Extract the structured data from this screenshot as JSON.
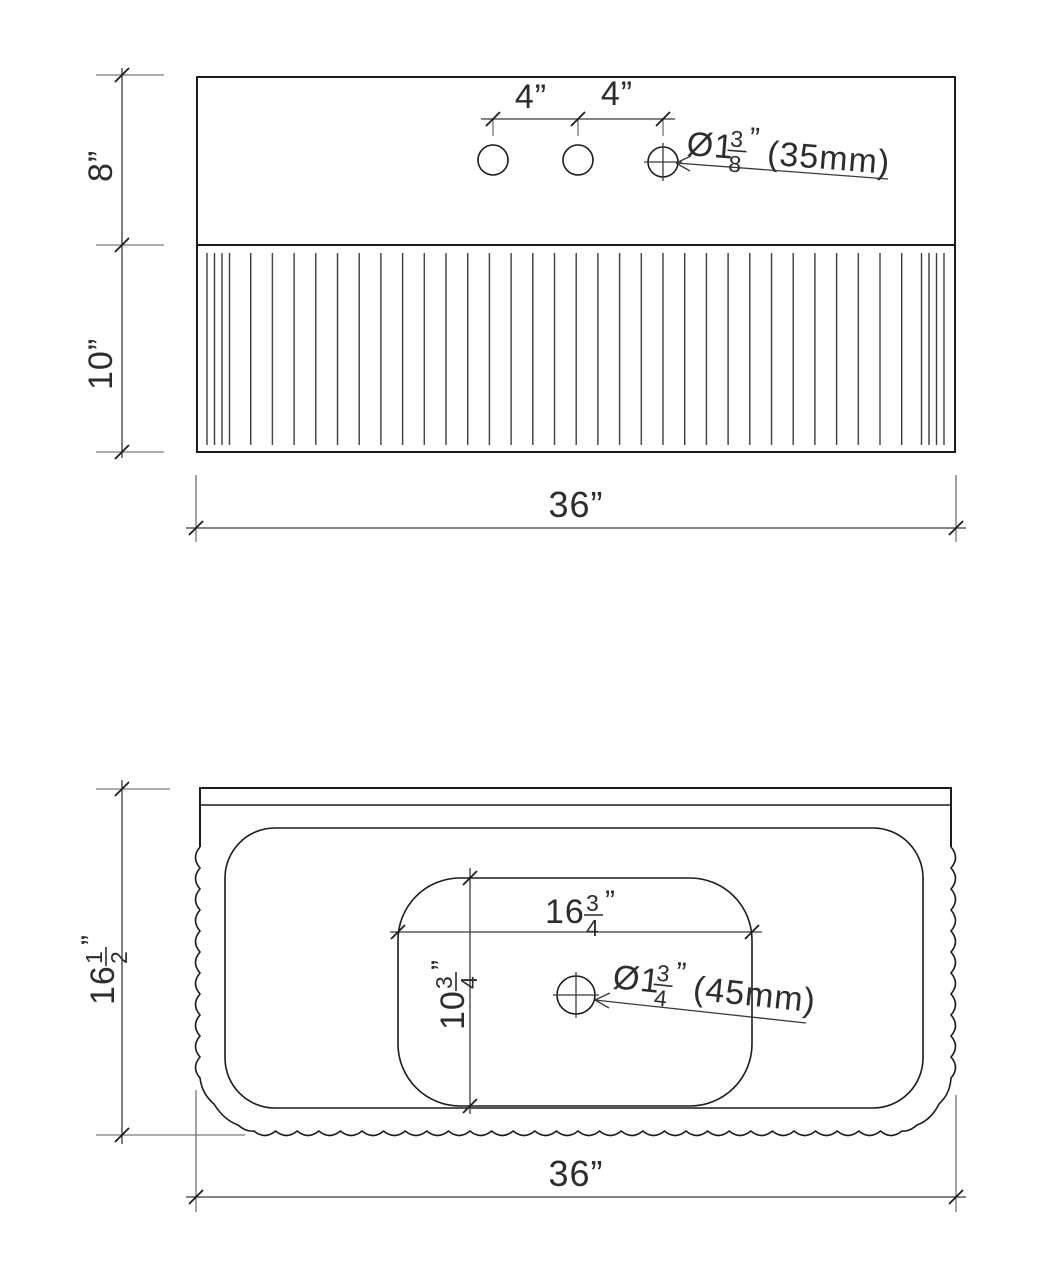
{
  "front": {
    "dim_top_height": "8”",
    "dim_flute_height": "10”",
    "dim_width": "36”",
    "dim_hole_left": "4”",
    "dim_hole_right": "4”",
    "callout_faucet": {
      "prefix": "Ø1",
      "num": "3",
      "den": "8",
      "unit": "”",
      "metric": "(35mm)"
    }
  },
  "plan": {
    "dim_depth": {
      "whole": "16",
      "num": "1",
      "den": "2",
      "unit": "”"
    },
    "dim_width": "36”",
    "dim_basin_width": {
      "whole": "16",
      "num": "3",
      "den": "4",
      "unit": "”"
    },
    "dim_basin_depth": {
      "whole": "10",
      "num": "3",
      "den": "4",
      "unit": "”"
    },
    "callout_drain": {
      "prefix": "Ø1",
      "num": "3",
      "den": "4",
      "unit": "”",
      "metric": "(45mm)"
    }
  }
}
